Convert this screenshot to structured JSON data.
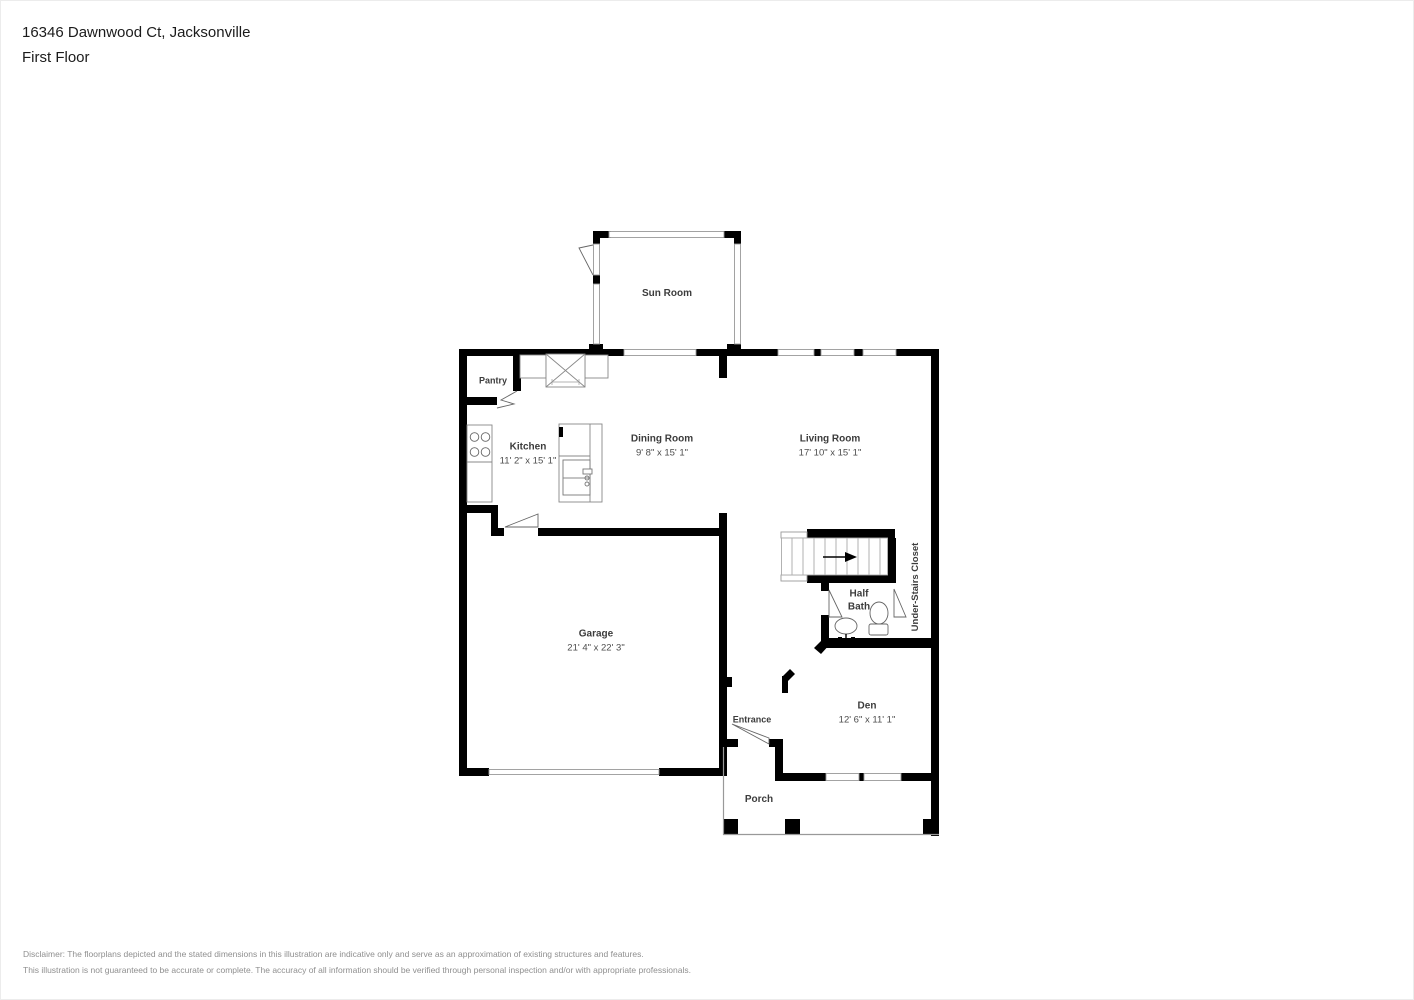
{
  "header": {
    "address": "16346 Dawnwood Ct, Jacksonville",
    "floor": "First Floor"
  },
  "rooms": {
    "sun_room": {
      "name": "Sun Room"
    },
    "pantry": {
      "name": "Pantry"
    },
    "kitchen": {
      "name": "Kitchen",
      "dims": "11' 2\" x 15' 1\""
    },
    "dining_room": {
      "name": "Dining Room",
      "dims": "9' 8\" x 15' 1\""
    },
    "living_room": {
      "name": "Living Room",
      "dims": "17' 10\" x 15' 1\""
    },
    "garage": {
      "name": "Garage",
      "dims": "21' 4\" x 22' 3\""
    },
    "half_bath": {
      "name": "Half Bath"
    },
    "under_stairs_closet": {
      "name": "Under-Stairs Closet"
    },
    "den": {
      "name": "Den",
      "dims": "12' 6\" x 11' 1\""
    },
    "entrance": {
      "name": "Entrance"
    },
    "porch": {
      "name": "Porch"
    }
  },
  "footer": {
    "line1": "Disclaimer: The floorplans depicted and the stated dimensions in this illustration are indicative only and serve as an approximation of existing structures and features.",
    "line2": "This illustration is not guaranteed to be accurate or complete. The accuracy of all information should be verified through personal inspection and/or with appropriate professionals."
  }
}
